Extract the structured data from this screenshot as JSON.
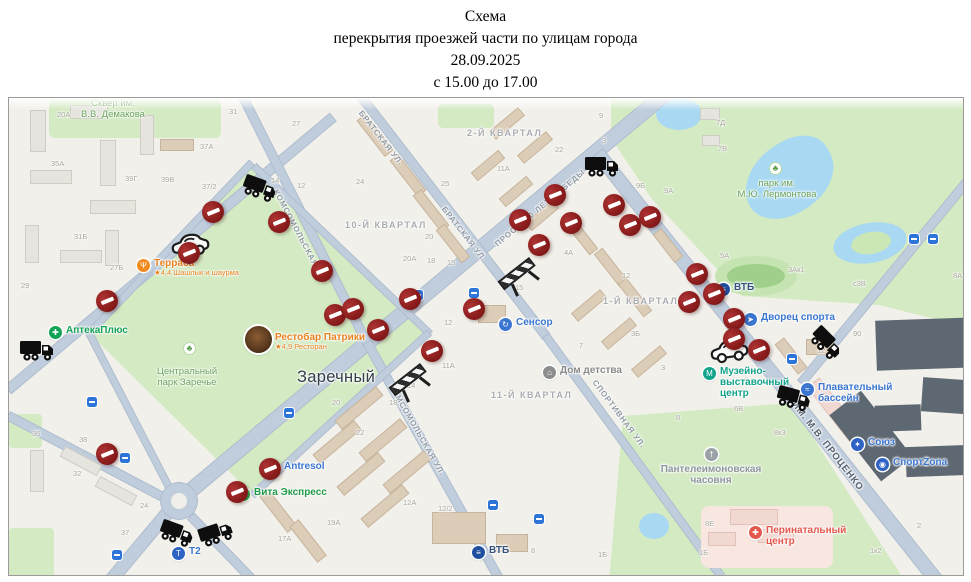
{
  "title": {
    "l1": "Схема",
    "l2": "перекрытия проезжей части по улицам города",
    "l3": "28.09.2025",
    "l4": "с 15.00 до 17.00"
  },
  "map": {
    "localities": [
      {
        "text": "Заречный",
        "x": 288,
        "y": 270
      }
    ],
    "quarters": [
      {
        "text": "2-Й КВАРТАЛ",
        "x": 458,
        "y": 30
      },
      {
        "text": "10-Й КВАРТАЛ",
        "x": 336,
        "y": 122
      },
      {
        "text": "1-Й КВАРТАЛ",
        "x": 594,
        "y": 198
      },
      {
        "text": "11-Й КВАРТАЛ",
        "x": 482,
        "y": 292
      }
    ],
    "streets": [
      {
        "text": "БРАТСКАЯ УЛ.",
        "x": 372,
        "y": 40,
        "rot": 52
      },
      {
        "text": "БРАТСКАЯ УЛ.",
        "x": 455,
        "y": 136,
        "rot": 52
      },
      {
        "text": "КОМСОМОЛЬСКАЯ УЛ.",
        "x": 291,
        "y": 138,
        "rot": 62
      },
      {
        "text": "КОМСОМОЛЬСКАЯ УЛ.",
        "x": 408,
        "y": 332,
        "rot": 60
      },
      {
        "text": "ПРОСП. 70 ЛЕТ ПОБЕДЫ",
        "x": 531,
        "y": 110,
        "rot": -40
      },
      {
        "text": "СПОРТИВНАЯ УЛ.",
        "x": 610,
        "y": 316,
        "rot": 53
      },
      {
        "text": "УЛ. ИМ. М.В. ПРОЦЕНКО",
        "x": 812,
        "y": 340,
        "rot": 52,
        "dark": true
      }
    ],
    "park_labels": [
      {
        "lines": [
          "Сквер им.",
          "В.В. Демакова"
        ],
        "x": 104,
        "y": 0
      },
      {
        "lines": [
          "парк им.",
          "М.Ю. Лермонтова"
        ],
        "x": 768,
        "y": 80,
        "tree": {
          "x": 760,
          "y": 64
        }
      },
      {
        "lines": [
          "Центральный",
          "парк Заречье"
        ],
        "x": 178,
        "y": 268,
        "tree": {
          "x": 174,
          "y": 244
        }
      }
    ],
    "pois": [
      {
        "id": "terrassa",
        "x": 128,
        "y": 161,
        "glyph": "Ψ",
        "bg": "#f28b1f",
        "color": "#e8821e",
        "lines": [
          "Терраса"
        ],
        "sub": "★4,4 Шашлык и шаурма"
      },
      {
        "id": "patriki",
        "x": 242,
        "y": 235,
        "photo": true,
        "color": "#e8821e",
        "lines": [
          "Рестобар Патрики"
        ],
        "sub": "★4,9 Ресторан"
      },
      {
        "id": "apteka-plus",
        "x": 40,
        "y": 228,
        "glyph": "✚",
        "bg": "#12a356",
        "color": "#12a356",
        "lines": [
          "АптекаПлюс"
        ]
      },
      {
        "id": "antresol",
        "x": 258,
        "y": 364,
        "glyph": "✂",
        "bg": "#2aa6c9",
        "color": "#3a76cf",
        "lines": [
          "Antresol"
        ]
      },
      {
        "id": "vita-express",
        "x": 228,
        "y": 390,
        "glyph": "✚",
        "bg": "#27b04b",
        "color": "#1f9a47",
        "lines": [
          "Вита Экспресс"
        ]
      },
      {
        "id": "sensor",
        "x": 490,
        "y": 220,
        "glyph": "↻",
        "bg": "#3a76cf",
        "color": "#3a76cf",
        "lines": [
          "Сенсор"
        ]
      },
      {
        "id": "dom-detstva",
        "x": 534,
        "y": 268,
        "glyph": "⌂",
        "bg": "#8d8d8d",
        "color": "#8a8a8a",
        "lines": [
          "Дом детства"
        ]
      },
      {
        "id": "vtb-north",
        "x": 708,
        "y": 185,
        "glyph": "≡",
        "bg": "#1f4f9e",
        "color": "#35517e",
        "lines": [
          "ВТБ"
        ]
      },
      {
        "id": "dvorets-sporta",
        "x": 735,
        "y": 215,
        "glyph": "➤",
        "bg": "#3a76cf",
        "color": "#3a76cf",
        "lines": [
          "Дворец спорта"
        ]
      },
      {
        "id": "muzeyno-vystavochny-centr",
        "x": 694,
        "y": 269,
        "glyph": "М",
        "bg": "#12a38b",
        "color": "#12a38b",
        "lines": [
          "Музейно-",
          "выставочный",
          "центр"
        ]
      },
      {
        "id": "plavatelny-bassein",
        "x": 792,
        "y": 285,
        "glyph": "≈",
        "bg": "#3a76cf",
        "color": "#3a76cf",
        "lines": [
          "Плавательный",
          "бассейн"
        ]
      },
      {
        "id": "soyuz",
        "x": 842,
        "y": 340,
        "glyph": "✦",
        "bg": "#2e63c4",
        "color": "#3a76cf",
        "lines": [
          "Союз"
        ]
      },
      {
        "id": "sportzona",
        "x": 867,
        "y": 360,
        "glyph": "◉",
        "bg": "#2e63c4",
        "color": "#3a76cf",
        "lines": [
          "СпортZona"
        ]
      },
      {
        "id": "panteleimonovskaya-chasovnya",
        "x": 696,
        "y": 350,
        "glyph": "†",
        "bg": "#9aa2a8",
        "color": "#8d959c",
        "lines": [
          "Пантелеимоновская",
          "часовня"
        ],
        "center": true
      },
      {
        "id": "perinatalny-centr",
        "x": 740,
        "y": 428,
        "glyph": "✚",
        "bg": "#e4574d",
        "color": "#e4574d",
        "lines": [
          "Перинатальный",
          "центр"
        ]
      },
      {
        "id": "t2",
        "x": 163,
        "y": 449,
        "glyph": "Т",
        "bg": "#2e63c4",
        "color": "#3a76cf",
        "lines": [
          "Т2"
        ]
      },
      {
        "id": "vtb-south",
        "x": 463,
        "y": 448,
        "glyph": "≡",
        "bg": "#1f4f9e",
        "color": "#35517e",
        "lines": [
          "ВТБ"
        ]
      }
    ],
    "numbers": [
      [
        48,
        12,
        "20А"
      ],
      [
        42,
        61,
        "35А"
      ],
      [
        116,
        76,
        "39Г"
      ],
      [
        152,
        77,
        "39В"
      ],
      [
        193,
        84,
        "37/2"
      ],
      [
        191,
        44,
        "37А"
      ],
      [
        220,
        9,
        "31"
      ],
      [
        283,
        21,
        "27"
      ],
      [
        262,
        78,
        "14"
      ],
      [
        288,
        83,
        "12"
      ],
      [
        65,
        134,
        "31Б"
      ],
      [
        101,
        165,
        "27Б"
      ],
      [
        12,
        183,
        "29"
      ],
      [
        347,
        79,
        "24"
      ],
      [
        432,
        81,
        "25"
      ],
      [
        546,
        47,
        "22"
      ],
      [
        488,
        66,
        "11А"
      ],
      [
        416,
        134,
        "20"
      ],
      [
        394,
        156,
        "20А"
      ],
      [
        418,
        158,
        "18"
      ],
      [
        438,
        160,
        "15"
      ],
      [
        627,
        83,
        "9Б"
      ],
      [
        593,
        38,
        "3"
      ],
      [
        590,
        13,
        "9"
      ],
      [
        555,
        150,
        "4А"
      ],
      [
        707,
        20,
        "7Д"
      ],
      [
        709,
        46,
        "7В"
      ],
      [
        655,
        88,
        "9А"
      ],
      [
        711,
        153,
        "5А"
      ],
      [
        779,
        167,
        "3Ак1"
      ],
      [
        844,
        181,
        "с3В"
      ],
      [
        844,
        231,
        "90"
      ],
      [
        808,
        248,
        "12"
      ],
      [
        944,
        173,
        "8А"
      ],
      [
        725,
        306,
        "6В"
      ],
      [
        667,
        315,
        "8"
      ],
      [
        652,
        265,
        "3"
      ],
      [
        613,
        173,
        "12"
      ],
      [
        506,
        185,
        "15"
      ],
      [
        435,
        220,
        "12"
      ],
      [
        433,
        263,
        "11А"
      ],
      [
        570,
        243,
        "7"
      ],
      [
        622,
        231,
        "3Б"
      ],
      [
        323,
        300,
        "20"
      ],
      [
        347,
        330,
        "22"
      ],
      [
        380,
        300,
        "18"
      ],
      [
        398,
        283,
        "14"
      ],
      [
        23,
        331,
        "36"
      ],
      [
        70,
        337,
        "38"
      ],
      [
        64,
        371,
        "32"
      ],
      [
        131,
        403,
        "24"
      ],
      [
        112,
        430,
        "37"
      ],
      [
        318,
        420,
        "19А"
      ],
      [
        269,
        436,
        "17А"
      ],
      [
        394,
        400,
        "12А"
      ],
      [
        429,
        406,
        "12/2"
      ],
      [
        522,
        448,
        "8"
      ],
      [
        589,
        452,
        "1Б"
      ],
      [
        765,
        330,
        "8к3"
      ],
      [
        696,
        421,
        "8Е"
      ],
      [
        690,
        450,
        "1Б"
      ],
      [
        861,
        448,
        "1к2"
      ],
      [
        908,
        423,
        "2"
      ]
    ],
    "markers": {
      "no_entry": [
        [
          193,
          103
        ],
        [
          259,
          113
        ],
        [
          169,
          144
        ],
        [
          87,
          192
        ],
        [
          302,
          162
        ],
        [
          315,
          206
        ],
        [
          333,
          200
        ],
        [
          358,
          221
        ],
        [
          390,
          190
        ],
        [
          412,
          242
        ],
        [
          454,
          200
        ],
        [
          500,
          111
        ],
        [
          519,
          136
        ],
        [
          535,
          86
        ],
        [
          551,
          114
        ],
        [
          594,
          96
        ],
        [
          610,
          116
        ],
        [
          630,
          108
        ],
        [
          677,
          165
        ],
        [
          669,
          193
        ],
        [
          694,
          185
        ],
        [
          714,
          210
        ],
        [
          714,
          230
        ],
        [
          739,
          241
        ],
        [
          87,
          345
        ],
        [
          250,
          360
        ],
        [
          217,
          383
        ]
      ],
      "trucks": [
        [
          233,
          78,
          20
        ],
        [
          575,
          56,
          0
        ],
        [
          10,
          240,
          0
        ],
        [
          800,
          233,
          45
        ],
        [
          767,
          288,
          15
        ],
        [
          150,
          423,
          20
        ],
        [
          189,
          423,
          -18
        ]
      ],
      "cars": [
        [
          160,
          133,
          -8
        ],
        [
          699,
          239,
          -8
        ]
      ],
      "barriers": [
        [
          489,
          165,
          -38
        ],
        [
          380,
          271,
          -38
        ]
      ],
      "transit": [
        [
          78,
          299
        ],
        [
          111,
          355
        ],
        [
          275,
          310
        ],
        [
          404,
          192
        ],
        [
          460,
          190
        ],
        [
          479,
          402
        ],
        [
          525,
          416
        ],
        [
          778,
          256
        ],
        [
          900,
          136
        ],
        [
          919,
          136
        ],
        [
          103,
          452
        ]
      ]
    }
  }
}
